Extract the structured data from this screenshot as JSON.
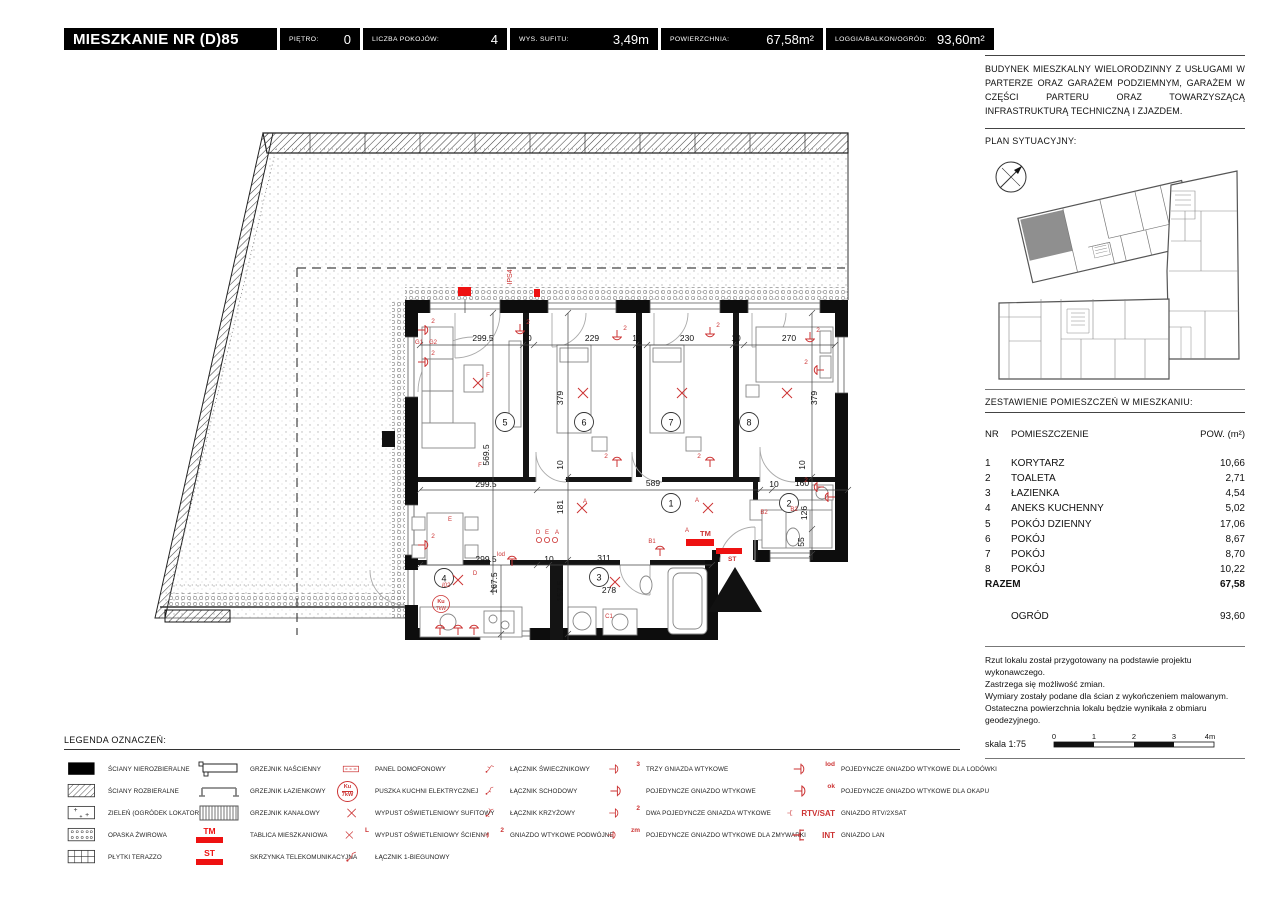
{
  "header": {
    "title": "MIESZKANIE NR (D)85",
    "fields": [
      {
        "label": "PIĘTRO:",
        "value": "0"
      },
      {
        "label": "LICZBA POKOJÓW:",
        "value": "4"
      },
      {
        "label": "WYS. SUFITU:",
        "value": "3,49m"
      },
      {
        "label": "POWIERZCHNIA:",
        "value": "67,58m²"
      },
      {
        "label": "LOGGIA/BALKON/OGRÓD:",
        "value": "93,60m²"
      }
    ]
  },
  "sidebar": {
    "description": "BUDYNEK MIESZKALNY WIELORODZINNY Z USŁUGAMI W PARTERZE ORAZ GARAŻEM PODZIEMNYM, GARAŻEM W CZĘŚCI PARTERU ORAZ TOWARZYSZĄCĄ INFRASTRUKTURĄ TECHNICZNĄ I ZJAZDEM.",
    "site_plan_heading": "PLAN SYTUACYJNY:",
    "rooms_heading": "ZESTAWIENIE POMIESZCZEŃ W MIESZKANIU:",
    "table": {
      "col_nr": "NR",
      "col_name": "POMIESZCZENIE",
      "col_area": "POW. (m²)",
      "rows": [
        {
          "nr": "1",
          "name": "KORYTARZ",
          "area": "10,66"
        },
        {
          "nr": "2",
          "name": "TOALETA",
          "area": "2,71"
        },
        {
          "nr": "3",
          "name": "ŁAZIENKA",
          "area": "4,54"
        },
        {
          "nr": "4",
          "name": "ANEKS KUCHENNY",
          "area": "5,02"
        },
        {
          "nr": "5",
          "name": "POKÓJ DZIENNY",
          "area": "17,06"
        },
        {
          "nr": "6",
          "name": "POKÓJ",
          "area": "8,67"
        },
        {
          "nr": "7",
          "name": "POKÓJ",
          "area": "8,70"
        },
        {
          "nr": "8",
          "name": "POKÓJ",
          "area": "10,22"
        }
      ],
      "total_label": "RAZEM",
      "total_value": "67,58",
      "garden_label": "OGRÓD",
      "garden_value": "93,60"
    },
    "notes": [
      "Rzut lokalu został przygotowany na podstawie projektu wykonawczego.",
      "Zastrzega się możliwość zmian.",
      "Wymiary zostały podane dla ścian z wykończeniem malowanym.",
      "Ostateczna powierzchnia lokalu będzie wynikała z obmiaru geodezyjnego."
    ],
    "scale_label": "skala 1:75",
    "scale_ticks": [
      "0",
      "1",
      "2",
      "3",
      "4m"
    ]
  },
  "plan": {
    "rooms": {
      "n1": "1",
      "n2": "2",
      "n3": "3",
      "n4": "4",
      "n5": "5",
      "n6": "6",
      "n7": "7",
      "n8": "8"
    },
    "dims": {
      "t1": "299.5",
      "t2": "10",
      "t3": "229",
      "t4": "10",
      "t5": "230",
      "t6": "10",
      "t7": "270",
      "m1": "299.5",
      "m2": "589",
      "m3": "10",
      "m4": "160",
      "b1": "299.5",
      "b2": "10",
      "b3": "311",
      "b4": "278",
      "v1": "569.5",
      "v2": "379",
      "v3": "379",
      "v4": "181",
      "v5": "167.5",
      "v6": "157.5",
      "v7": "126",
      "v8": "55",
      "v9": "10",
      "v10": "10"
    },
    "labels": {
      "rtv": "RTV/SAT",
      "int": "INT",
      "tm": "TM",
      "st": "ST",
      "ips": "IPS4",
      "g1": "G1",
      "g2": "G2",
      "b1": "B1",
      "b2": "B2",
      "c1": "C1",
      "a": "A",
      "d": "D",
      "e": "E",
      "f": "F",
      "i02": "I02",
      "lod": "lod",
      "ku": "Ku",
      "kw": "7kW",
      "s2": "2"
    }
  },
  "legend": {
    "heading": "LEGENDA OZNACZEŃ:",
    "cols": [
      [
        {
          "icon": "wall-solid-icon",
          "label": "ŚCIANY NIEROZBIERALNE"
        },
        {
          "icon": "wall-removable-icon",
          "label": "ŚCIANY ROZBIERALNE"
        },
        {
          "icon": "green-icon",
          "label": "ZIELEŃ (OGRÓDEK LOKATORSKI)"
        },
        {
          "icon": "gravel-icon",
          "label": "OPASKA ŻWIROWA"
        },
        {
          "icon": "terrazzo-icon",
          "label": "PŁYTKI TERAZZO"
        }
      ],
      [
        {
          "icon": "radiator-wall-icon",
          "label": "GRZEJNIK NAŚCIENNY"
        },
        {
          "icon": "radiator-bath-icon",
          "label": "GRZEJNIK ŁAZIENKOWY"
        },
        {
          "icon": "radiator-duct-icon",
          "label": "GRZEJNIK KANAŁOWY"
        },
        {
          "badge": true,
          "tag": "TM",
          "label": "TABLICA MIESZKANIOWA"
        },
        {
          "badge": true,
          "tag": "ST",
          "label": "SKRZYNKA TELEKOMUNIKACYJNA"
        }
      ],
      [
        {
          "icon": "intercom-icon",
          "label": "PANEL DOMOFONOWY"
        },
        {
          "circle": true,
          "tag1": "Ku",
          "tag2": "7kW",
          "label": "PUSZKA KUCHNI ELEKTRYCZNEJ"
        },
        {
          "icon": "lamp-x-icon",
          "label": "WYPUST OŚWIETLENIOWY SUFITOWY"
        },
        {
          "icon": "lamp-x-icon",
          "tag": "L",
          "label": "WYPUST OŚWIETLENIOWY ŚCIENNY"
        },
        {
          "icon": "switch-1-icon",
          "label": "ŁĄCZNIK 1-BIEGUNOWY"
        }
      ],
      [
        {
          "icon": "switch-chandelier-icon",
          "label": "ŁĄCZNIK ŚWIECZNIKOWY"
        },
        {
          "icon": "switch-stairs-icon",
          "label": "ŁĄCZNIK SCHODOWY"
        },
        {
          "icon": "switch-cross-icon",
          "label": "ŁĄCZNIK KRZYŻOWY"
        },
        {
          "icon": "socket-icon",
          "tag": "2",
          "label": "GNIAZDO WTYKOWE PODWÓJNE"
        }
      ],
      [
        {
          "icon": "socket-icon",
          "tag": "3",
          "label": "TRZY GNIAZDA WTYKOWE"
        },
        {
          "icon": "socket-icon",
          "label": "POJEDYNCZE GNIAZDO WTYKOWE"
        },
        {
          "icon": "socket-icon",
          "tag": "2",
          "label": "DWA POJEDYNCZE GNIAZDA WTYKOWE"
        },
        {
          "icon": "socket-icon",
          "tag": "zm",
          "label": "POJEDYNCZE GNIAZDO WTYKOWE DLA ZMYWARKI"
        }
      ],
      [
        {
          "icon": "socket-icon",
          "tag": "lod",
          "label": "POJEDYNCZE GNIAZDO WTYKOWE DLA LODÓWKI"
        },
        {
          "icon": "socket-icon",
          "tag": "ok",
          "label": "POJEDYNCZE GNIAZDO WTYKOWE DLA OKAPU"
        },
        {
          "icon": "socket-rtv-icon",
          "tag": "RTV/SAT",
          "big": true,
          "label": "GNIAZDO RTV/2XSAT"
        },
        {
          "icon": "socket-rtv-icon",
          "tag": "INT",
          "big": true,
          "label": "GNIAZDO LAN"
        }
      ]
    ]
  }
}
